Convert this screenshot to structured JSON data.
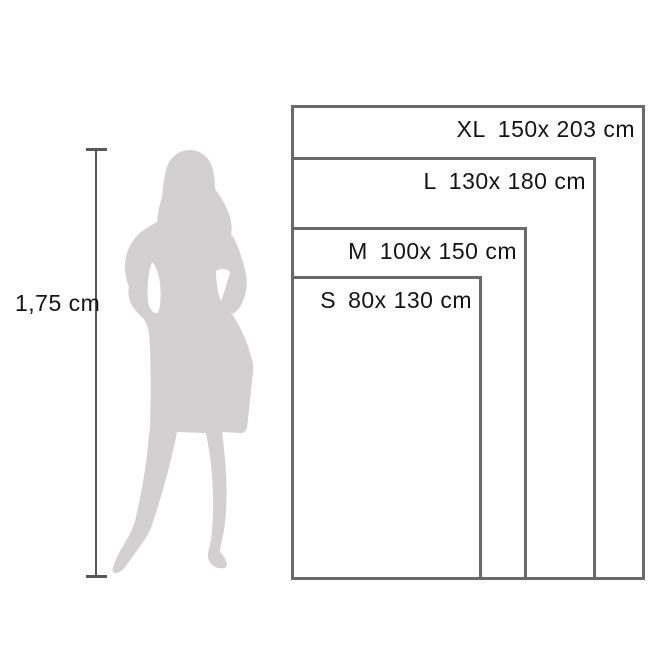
{
  "diagram": {
    "height_reference": {
      "label": "1,75 cm"
    },
    "sizes": [
      {
        "code": "XL",
        "dims": "150x 203 cm"
      },
      {
        "code": "L",
        "dims": "130x 180 cm"
      },
      {
        "code": "M",
        "dims": "100x 150 cm"
      },
      {
        "code": "S",
        "dims": "80x 130 cm"
      }
    ],
    "colors": {
      "silhouette": "#d2d0d1",
      "box_border": "#6a6a6c",
      "measure_line": "#58585a",
      "text": "#141414",
      "background": "#ffffff"
    }
  }
}
